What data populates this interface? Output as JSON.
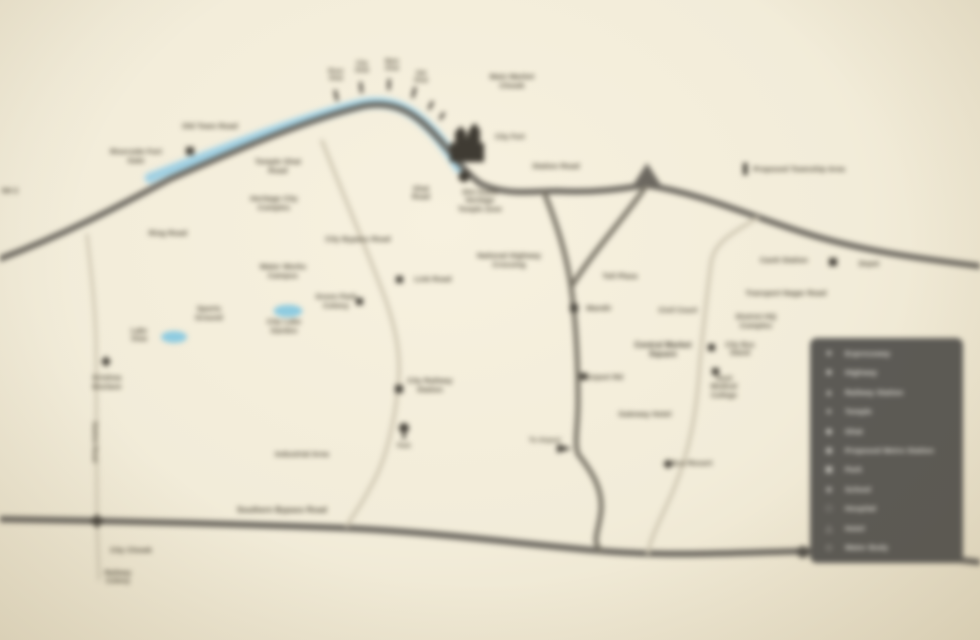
{
  "map": {
    "colors": {
      "background": "#f2ecd9",
      "highway": "#6c6860",
      "secondary_road": "#7a7568",
      "rural_road": "#cdc5b0",
      "river": "#9fcfe2",
      "pond": "#8ecbe0",
      "label_text": "#4e483a",
      "marker": "#46423a",
      "legend_background": "#5c5a55",
      "legend_text": "#e6e3db"
    },
    "labels": [
      {
        "id": "nh-left",
        "x": 10,
        "y": 192,
        "size": 7,
        "lines": [
          "NH 2"
        ]
      },
      {
        "id": "old-town-road",
        "x": 210,
        "y": 127,
        "size": 7.5,
        "lines": [
          "Old Town Road"
        ]
      },
      {
        "id": "riverside-fort",
        "x": 136,
        "y": 157,
        "size": 7.5,
        "lines": [
          "Riverside Fort",
          "Gate"
        ]
      },
      {
        "id": "temple-ghat-road",
        "x": 278,
        "y": 167,
        "size": 7.5,
        "lines": [
          "Temple Ghat",
          "Road"
        ]
      },
      {
        "id": "heritage-complex",
        "x": 274,
        "y": 204,
        "size": 7.5,
        "lines": [
          "Heritage City",
          "Complex"
        ]
      },
      {
        "id": "ring-road",
        "x": 168,
        "y": 234,
        "size": 7.5,
        "lines": [
          "Ring Road"
        ]
      },
      {
        "id": "ghat-1",
        "x": 336,
        "y": 76,
        "size": 6,
        "lines": [
          "River",
          "Ghat"
        ]
      },
      {
        "id": "ghat-2",
        "x": 362,
        "y": 68,
        "size": 6,
        "lines": [
          "City",
          "Ghat"
        ]
      },
      {
        "id": "ghat-3",
        "x": 392,
        "y": 66,
        "size": 6,
        "lines": [
          "Main",
          "Ghat"
        ]
      },
      {
        "id": "ghat-4",
        "x": 421,
        "y": 78,
        "size": 6,
        "lines": [
          "Old",
          "Ghat"
        ]
      },
      {
        "id": "main-market",
        "x": 512,
        "y": 82,
        "size": 7.5,
        "lines": [
          "Main Market",
          "Chowk"
        ]
      },
      {
        "id": "city-fort",
        "x": 510,
        "y": 138,
        "size": 7,
        "lines": [
          "City Fort"
        ]
      },
      {
        "id": "temple-zone",
        "x": 480,
        "y": 202,
        "size": 7,
        "lines": [
          "Shri Kashi",
          "Heritage",
          "Temple Zone"
        ]
      },
      {
        "id": "ghat-road",
        "x": 421,
        "y": 194,
        "size": 7,
        "lines": [
          "Ghat",
          "Road"
        ]
      },
      {
        "id": "station-road-north",
        "x": 556,
        "y": 167,
        "size": 7.5,
        "lines": [
          "Station Road"
        ]
      },
      {
        "id": "proposed-township",
        "x": 799,
        "y": 170,
        "size": 7.5,
        "lines": [
          "Proposed Township Area"
        ]
      },
      {
        "id": "nh-crossing",
        "x": 509,
        "y": 261,
        "size": 7.5,
        "lines": [
          "National Highway",
          "Crossing"
        ]
      },
      {
        "id": "toll-plaza",
        "x": 620,
        "y": 277,
        "size": 7.5,
        "lines": [
          "Toll Plaza"
        ]
      },
      {
        "id": "city-bypass",
        "x": 358,
        "y": 240,
        "size": 7.5,
        "lines": [
          "City Bypass Road"
        ]
      },
      {
        "id": "link-road",
        "x": 433,
        "y": 280,
        "size": 7.5,
        "lines": [
          "Link Road"
        ]
      },
      {
        "id": "green-park-colony",
        "x": 336,
        "y": 302,
        "size": 7.5,
        "lines": [
          "Green Park",
          "Colony"
        ]
      },
      {
        "id": "water-works",
        "x": 283,
        "y": 272,
        "size": 7.5,
        "lines": [
          "Water Works",
          "Campus"
        ]
      },
      {
        "id": "city-lake-garden",
        "x": 284,
        "y": 327,
        "size": 7.5,
        "lines": [
          "City Lake",
          "Garden"
        ]
      },
      {
        "id": "lake-view",
        "x": 139,
        "y": 336,
        "size": 7,
        "lines": [
          "Lake",
          "View"
        ]
      },
      {
        "id": "sports-ground",
        "x": 209,
        "y": 314,
        "size": 7.5,
        "lines": [
          "Sports",
          "Ground"
        ]
      },
      {
        "id": "krishna-enclave",
        "x": 107,
        "y": 383,
        "size": 7.5,
        "lines": [
          "Krishna",
          "Enclave"
        ]
      },
      {
        "id": "station-road-west",
        "x": 94,
        "y": 442,
        "size": 6.5,
        "rotate": 90,
        "lines": [
          "Station Road"
        ]
      },
      {
        "id": "industrial-area",
        "x": 302,
        "y": 455,
        "size": 7.5,
        "lines": [
          "Industrial Area"
        ]
      },
      {
        "id": "southern-bypass",
        "x": 282,
        "y": 510,
        "size": 8,
        "lines": [
          "Southern Bypass Road"
        ]
      },
      {
        "id": "city-chowk",
        "x": 131,
        "y": 551,
        "size": 7.5,
        "lines": [
          "City Chowk"
        ]
      },
      {
        "id": "railway-colony",
        "x": 118,
        "y": 578,
        "size": 7,
        "lines": [
          "Railway",
          "Colony"
        ]
      },
      {
        "id": "city-railway-station",
        "x": 430,
        "y": 386,
        "size": 7.5,
        "lines": [
          "City Railway",
          "Station"
        ]
      },
      {
        "id": "park",
        "x": 404,
        "y": 447,
        "size": 6,
        "lines": [
          "Park"
        ]
      },
      {
        "id": "mandir",
        "x": 599,
        "y": 309,
        "size": 7.5,
        "lines": [
          "Mandir"
        ]
      },
      {
        "id": "civil-court",
        "x": 678,
        "y": 311,
        "size": 7.5,
        "lines": [
          "Civil Court"
        ]
      },
      {
        "id": "central-market",
        "x": 663,
        "y": 350,
        "size": 8,
        "bold": true,
        "lines": [
          "Central Market",
          "Square"
        ]
      },
      {
        "id": "district-hq",
        "x": 756,
        "y": 322,
        "size": 7.5,
        "lines": [
          "District HQ",
          "Complex"
        ]
      },
      {
        "id": "cantt-station",
        "x": 784,
        "y": 261,
        "size": 7.5,
        "lines": [
          "Cantt Station"
        ]
      },
      {
        "id": "depot",
        "x": 869,
        "y": 265,
        "size": 7,
        "lines": [
          "Depot"
        ]
      },
      {
        "id": "transport-nagar",
        "x": 786,
        "y": 294,
        "size": 7.5,
        "lines": [
          "Transport Nagar Road"
        ]
      },
      {
        "id": "city-bus-stand",
        "x": 740,
        "y": 350,
        "size": 7,
        "lines": [
          "City Bus",
          "Stand"
        ]
      },
      {
        "id": "medical-college",
        "x": 724,
        "y": 388,
        "size": 7,
        "lines": [
          "Govt",
          "Medical",
          "College"
        ]
      },
      {
        "id": "airport-road",
        "x": 604,
        "y": 378,
        "size": 7.5,
        "lines": [
          "Airport Rd"
        ]
      },
      {
        "id": "gateway-hotel",
        "x": 645,
        "y": 415,
        "size": 7.5,
        "lines": [
          "Gateway Hotel"
        ]
      },
      {
        "id": "eco-resort",
        "x": 692,
        "y": 464,
        "size": 7.5,
        "lines": [
          "Eco Resort"
        ]
      },
      {
        "id": "to-airport",
        "x": 545,
        "y": 441,
        "size": 6.5,
        "lines": [
          "To Airport"
        ]
      }
    ],
    "legend": {
      "items": [
        {
          "icon": "★",
          "icon_name": "star-icon",
          "label": "Expressway"
        },
        {
          "icon": "■",
          "icon_name": "square-icon",
          "label": "Highway"
        },
        {
          "icon": "▲",
          "icon_name": "triangle-icon",
          "label": "Railway Station"
        },
        {
          "icon": "●",
          "icon_name": "circle-icon",
          "label": "Temple"
        },
        {
          "icon": "◆",
          "icon_name": "diamond-icon",
          "label": "Ghat"
        },
        {
          "icon": "◉",
          "icon_name": "target-icon",
          "label": "Proposed Metro Station"
        },
        {
          "icon": "▣",
          "icon_name": "framed-square-icon",
          "label": "Park"
        },
        {
          "icon": "◈",
          "icon_name": "framed-diamond-icon",
          "label": "School"
        },
        {
          "icon": "□",
          "icon_name": "hollow-square-icon",
          "label": "Hospital"
        },
        {
          "icon": "△",
          "icon_name": "hollow-triangle-icon",
          "label": "Hotel"
        },
        {
          "icon": "◇",
          "icon_name": "hollow-diamond-icon",
          "label": "Water Body"
        }
      ]
    }
  }
}
